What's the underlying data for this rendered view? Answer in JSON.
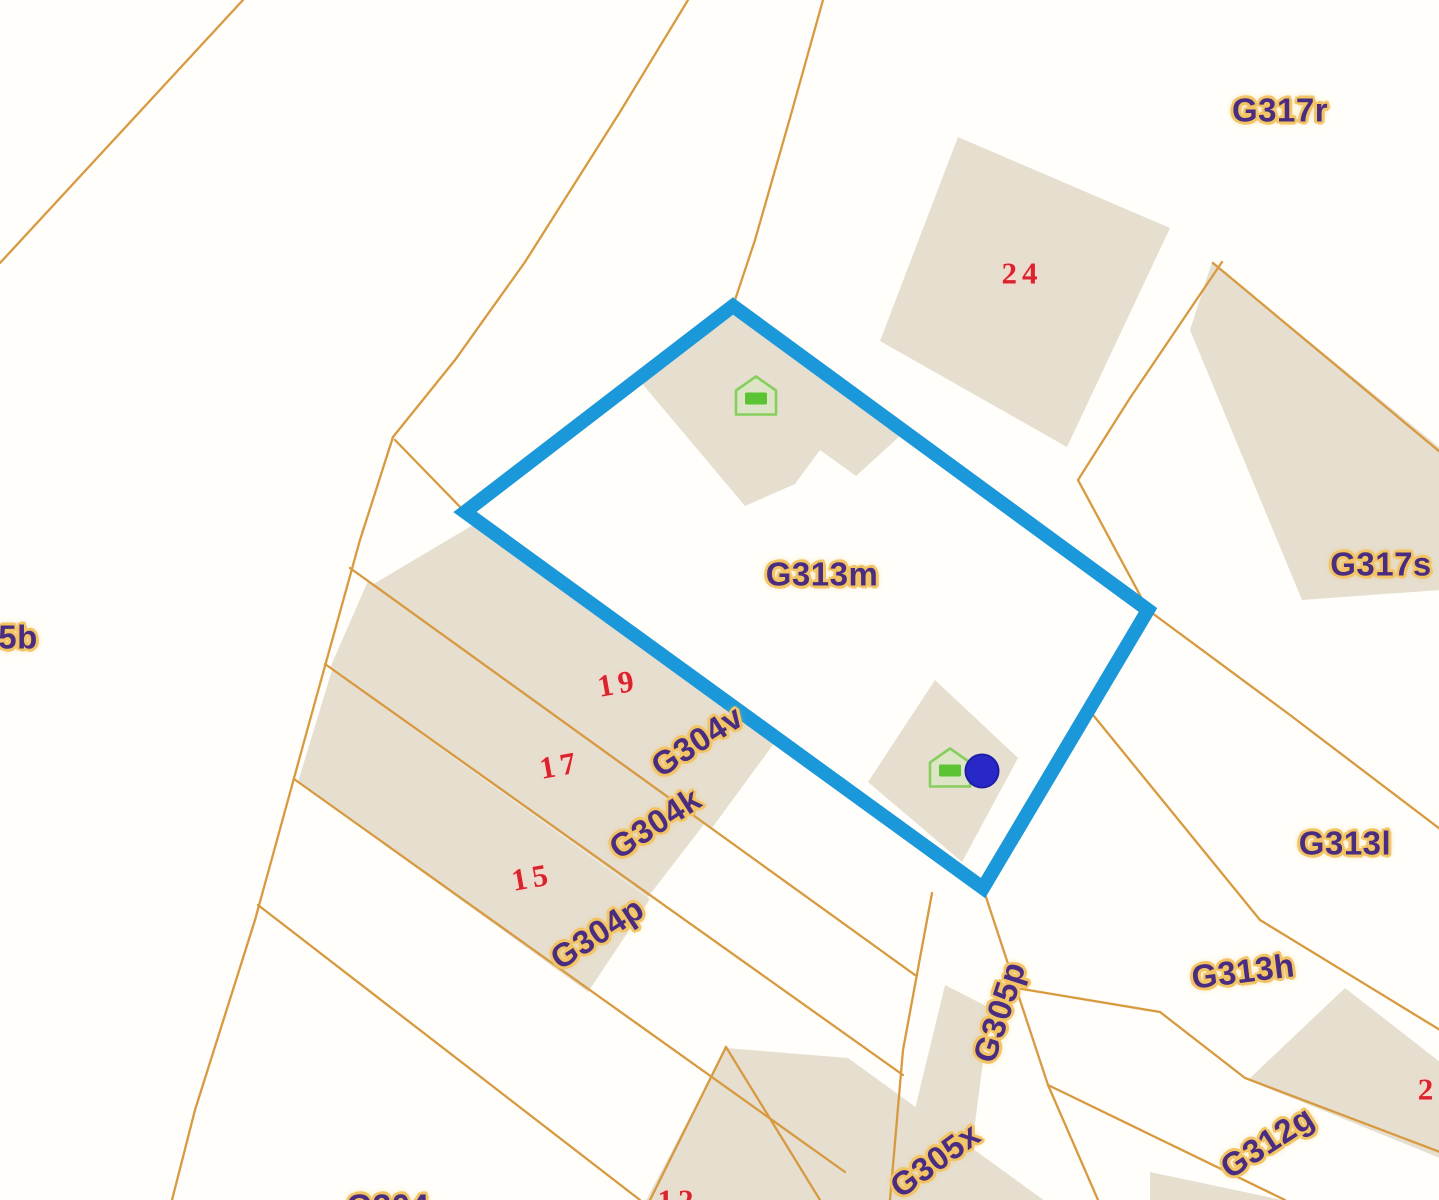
{
  "map": {
    "selected_parcel": "G313m",
    "colors": {
      "parcel_line": "#d79a40",
      "building_fill": "#e6decf",
      "selection_outline": "#1b98da",
      "parcel_label_text": "#4a2d80",
      "parcel_label_halo": "#f2c464",
      "house_number_text": "#d9232f",
      "marker_dot": "#2828c8",
      "house_icon_green": "#5cc335",
      "house_icon_outline": "#86cf5e"
    },
    "labels": [
      {
        "text": "G317r",
        "x": 1280,
        "y": 110,
        "rot": 0,
        "kind": "parcel"
      },
      {
        "text": "G317s",
        "x": 1381,
        "y": 564,
        "rot": 0,
        "kind": "parcel"
      },
      {
        "text": "G313m",
        "x": 822,
        "y": 574,
        "rot": 0,
        "kind": "parcel"
      },
      {
        "text": "G313l",
        "x": 1345,
        "y": 843,
        "rot": 0,
        "kind": "parcel"
      },
      {
        "text": "G313h",
        "x": 1243,
        "y": 971,
        "rot": -7,
        "kind": "parcel"
      },
      {
        "text": "G312g",
        "x": 1267,
        "y": 1142,
        "rot": -33,
        "kind": "parcel"
      },
      {
        "text": "G305p",
        "x": 999,
        "y": 1012,
        "rot": -72,
        "kind": "parcel"
      },
      {
        "text": "G305x",
        "x": 935,
        "y": 1160,
        "rot": -36,
        "kind": "parcel"
      },
      {
        "text": "G304v",
        "x": 697,
        "y": 741,
        "rot": -33,
        "kind": "parcel"
      },
      {
        "text": "G304k",
        "x": 655,
        "y": 823,
        "rot": -33,
        "kind": "parcel"
      },
      {
        "text": "G304p",
        "x": 597,
        "y": 933,
        "rot": -33,
        "kind": "parcel"
      },
      {
        "text": "5b",
        "x": 18,
        "y": 637,
        "rot": 0,
        "kind": "parcel"
      },
      {
        "text": "G304",
        "x": 388,
        "y": 1206,
        "rot": 0,
        "kind": "parcel"
      },
      {
        "text": "24",
        "x": 1022,
        "y": 273,
        "rot": 0,
        "kind": "number"
      },
      {
        "text": "19",
        "x": 618,
        "y": 683,
        "rot": -10,
        "kind": "number"
      },
      {
        "text": "17",
        "x": 560,
        "y": 765,
        "rot": -10,
        "kind": "number"
      },
      {
        "text": "15",
        "x": 532,
        "y": 877,
        "rot": -10,
        "kind": "number"
      },
      {
        "text": "12",
        "x": 678,
        "y": 1200,
        "rot": 0,
        "kind": "number"
      },
      {
        "text": "2",
        "x": 1428,
        "y": 1089,
        "rot": 0,
        "kind": "number"
      }
    ],
    "markers": [
      {
        "type": "house",
        "x": 756,
        "y": 398
      },
      {
        "type": "house",
        "x": 950,
        "y": 770
      },
      {
        "type": "dot",
        "x": 982,
        "y": 771
      }
    ]
  }
}
